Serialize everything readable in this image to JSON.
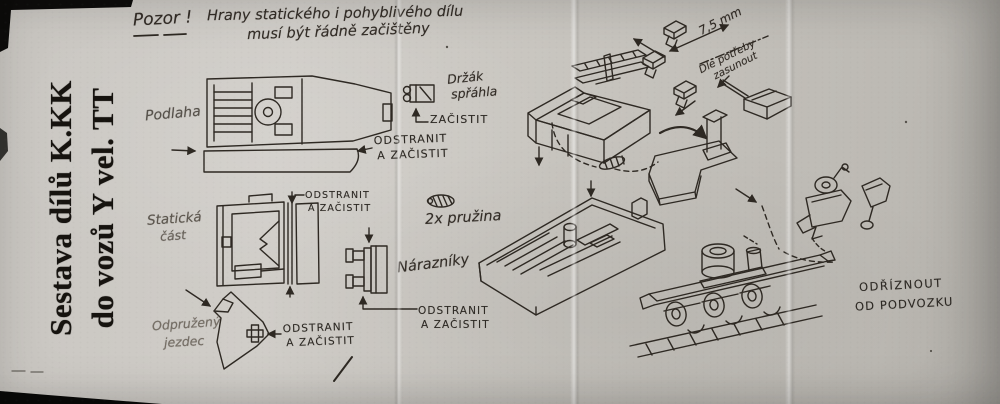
{
  "title": {
    "line1": "Sestava dílů K.KK",
    "line2": "do vozů Y vel. TT"
  },
  "warning": {
    "heading": "Pozor !",
    "line1": "Hrany statického i pohyblivého dílu",
    "line2": "musí být řádně začištěny"
  },
  "part_labels": {
    "floor": "Podlaha",
    "static_line1": "Statická",
    "static_line2": "část",
    "slider_line1": "Odpružený",
    "slider_line2": "jezdec"
  },
  "annotations": {
    "holder_line1": "Držák",
    "holder_line2": "spřáhla",
    "clean": "ZAČISTIT",
    "remove_line1": "ODSTRANIT",
    "remove_line2": "A ZAČISTIT",
    "springs": "2x pružina",
    "buffers": "Nárazníky",
    "dimension": "7,5 mm",
    "push_line1": "Dle potřeby",
    "push_line2": "zasunout",
    "cut_line1": "ODŘÍZNOUT",
    "cut_line2": "OD PODVOZKU"
  },
  "colors": {
    "paper": "#c8c5c0",
    "ink": "#2e2923"
  }
}
